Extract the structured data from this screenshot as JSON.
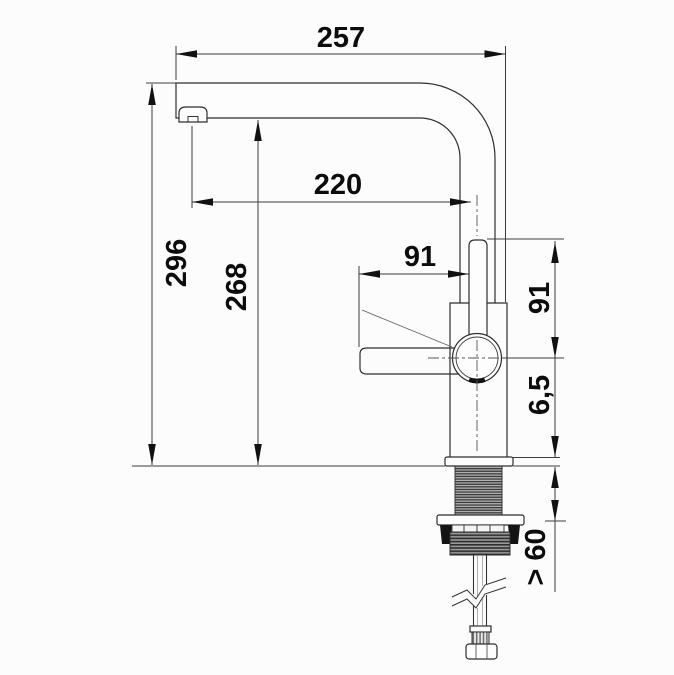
{
  "drawing": {
    "type": "technical-dimension-drawing",
    "subject": "kitchen-mixer-tap-side-view"
  },
  "colors": {
    "background": "#fcfcfc",
    "line": "#3d3d3d",
    "text": "#0c0c0c",
    "arrow": "#111111"
  },
  "dimensions": [
    {
      "id": "spout-overall-width",
      "label": "257",
      "orientation": "horizontal"
    },
    {
      "id": "spout-reach",
      "label": "220",
      "orientation": "horizontal"
    },
    {
      "id": "overall-height",
      "label": "296",
      "orientation": "vertical"
    },
    {
      "id": "outlet-height",
      "label": "268",
      "orientation": "vertical"
    },
    {
      "id": "lever-reach",
      "label": "91",
      "orientation": "horizontal"
    },
    {
      "id": "spout-end-to-lever-axis",
      "label": "91",
      "orientation": "vertical"
    },
    {
      "id": "base-plate-thickness",
      "label": "6,5",
      "orientation": "vertical"
    },
    {
      "id": "min-clearance-below-deck",
      "label": "> 60",
      "orientation": "vertical"
    }
  ]
}
